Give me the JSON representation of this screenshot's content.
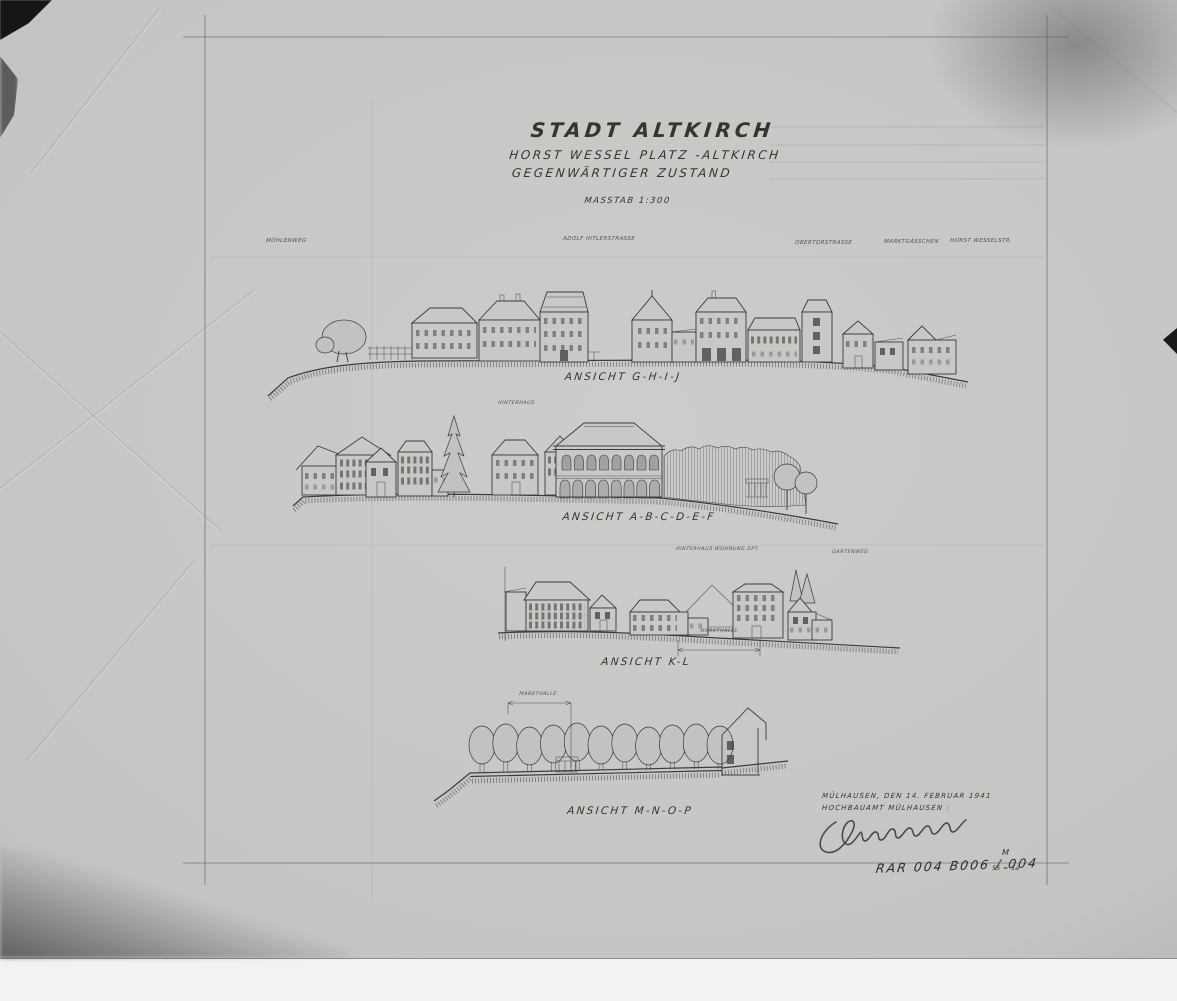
{
  "document": {
    "title": "STADT ALTKIRCH",
    "subtitle_line1": "HORST WESSEL PLATZ -ALTKIRCH",
    "subtitle_line2": "GEGENWÄRTIGER ZUSTAND",
    "scale_note": "MASSTAB 1:300"
  },
  "street_labels": {
    "far_left": "MÜHLENWEG",
    "left": "ADOLF HITLERSTRASSE",
    "right1": "OBERTORSTRASSE",
    "right2": "MARKTGÄSSCHEN",
    "right3": "HORST WESSELSTR."
  },
  "elevations": {
    "ghij": {
      "caption": "ANSICHT G-H-I-J"
    },
    "abcdef": {
      "caption": "ANSICHT A-B-C-D-E-F",
      "note": "HINTERHAUS"
    },
    "kl": {
      "caption": "ANSICHT K-L",
      "note_left": "HINTERHAUS WOHNUNG DPT.",
      "note_right": "GARTENWEG",
      "dimension_label": "MARKTHALLE"
    },
    "mnop": {
      "caption": "ANSICHT M-N-O-P",
      "dimension_label": "MARKTHALLE"
    }
  },
  "footer": {
    "place_date": "MÜLHAUSEN, DEN 14. FEBRUAR 1941",
    "office": "HOCHBAUAMT MÜLHAUSEN :"
  },
  "archive": {
    "reference_number": "RAR 004 B006 / 004",
    "sheet_code": "55 = 5a",
    "corner_mark": "M"
  },
  "ruler": {
    "unit_labels": [
      "cm",
      "1",
      "2",
      "3",
      "4",
      "5",
      "6",
      "7",
      "8",
      "9",
      "10"
    ]
  },
  "colors": {
    "ink": "#3b3b39",
    "paper": "#c6c6c4",
    "photo_background": "#b9b9b7",
    "scan_strip": "#f2f2f0"
  }
}
